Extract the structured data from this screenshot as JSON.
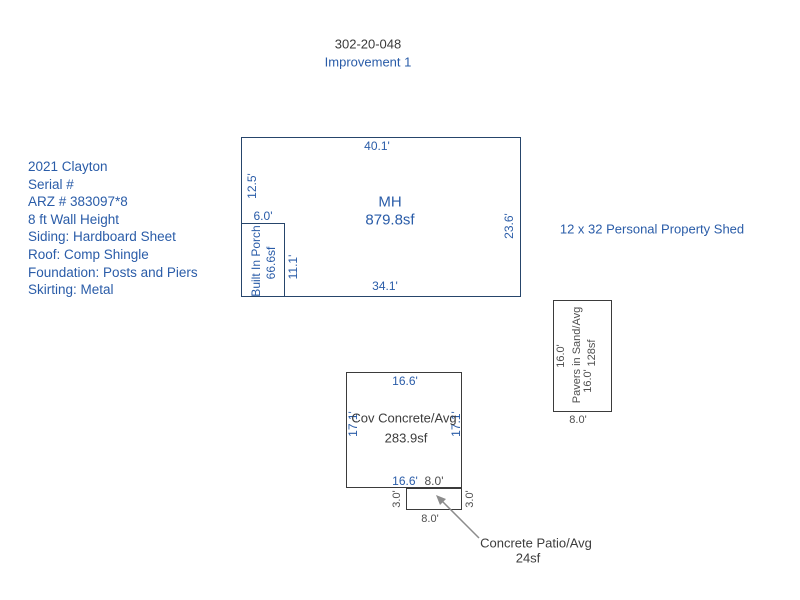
{
  "header": {
    "parcel": "302-20-048",
    "improvement": "Improvement 1"
  },
  "property_info": {
    "lines": [
      "2021 Clayton",
      "Serial #",
      "ARZ # 383097*8",
      "8 ft Wall Height",
      "Siding: Hardboard Sheet",
      "Roof: Comp Shingle",
      "Foundation: Posts and Piers",
      "Skirting: Metal"
    ]
  },
  "shed_note": "12 x 32 Personal Property Shed",
  "mh": {
    "name": "MH",
    "area": "879.8sf",
    "dim_top": "40.1'",
    "dim_left_upper": "12.5'",
    "dim_right": "23.6'",
    "dim_bottom": "34.1'"
  },
  "porch": {
    "name": "Built In Porch",
    "area": "66.6sf",
    "dim_top": "6.0'",
    "dim_right": "11.1'"
  },
  "cov_concrete": {
    "name": "Cov Concrete/Avg",
    "area": "283.9sf",
    "dim_top": "16.6'",
    "dim_left": "17.1'",
    "dim_right": "17.1'",
    "dim_bottom_left": "16.6'",
    "dim_bottom_right": "8.0'"
  },
  "patio": {
    "name": "Concrete Patio/Avg",
    "area": "24sf",
    "dim_left": "3.0'",
    "dim_right": "3.0'",
    "dim_bottom": "8.0'"
  },
  "pavers": {
    "name": "Pavers in Sand/Avg",
    "area": "128sf",
    "dim_left": "16.0'",
    "dim_right": "16.0'",
    "dim_bottom": "8.0'"
  },
  "colors": {
    "dimension_blue": "#2a5ca8",
    "outline_navy": "#26456b",
    "outline_dark": "#3b3b3b",
    "name_dark": "#3c3c3c",
    "yard_gray": "#4f4f4f",
    "arrow_gray": "#8c8c8c",
    "title_dark": "#3a3a3a"
  }
}
